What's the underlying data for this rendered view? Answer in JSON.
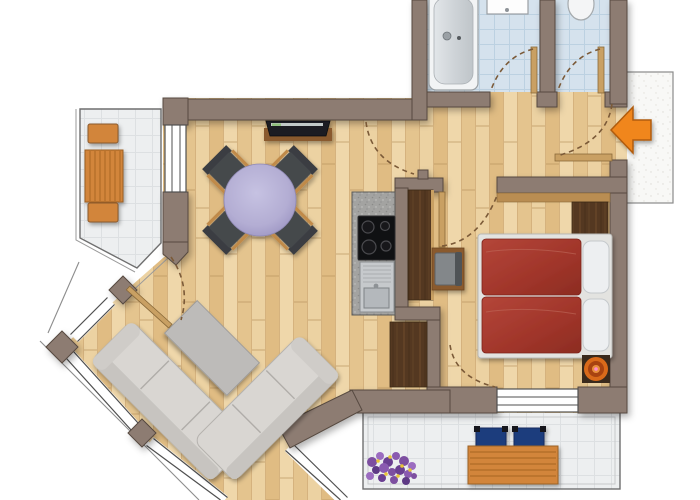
{
  "title": "apartment-floor-plan",
  "colors": {
    "wall": "#8d7b72",
    "wall_edge": "#574a40",
    "floor_wood": "#eacf9e",
    "tile_bathroom": "#d5e2ed",
    "tile_bathroom_line": "#bcd1e1",
    "tile_balcony": "#edeff0",
    "tile_balcony_line": "#dde0e2",
    "railing": "#6f6f6f",
    "sofa": "#d9d6d2",
    "coffee_table": "#bdbbb9",
    "dining_table": "#b5afd4",
    "dining_chair": "#45484c",
    "chair_wood_trim": "#c08a4a",
    "counter_granite": "#a3a3a1",
    "cooktop": "#101113",
    "sink_steel": "#c6c9cc",
    "wardrobe_wood": "#543821",
    "shelf_wood": "#b98d52",
    "door_wood": "#c9a063",
    "door_arc": "#7b5a38",
    "bed_duvet": "#a63a2f",
    "bed_frame": "#e3e3e0",
    "pillow": "#edeff1",
    "stool_orange": "#d96a1a",
    "entrance_arrow": "#f0861c",
    "outdoor_wood": "#d2853b",
    "outdoor_chair_blue": "#1f3d7d",
    "flower_purple": "#7d4fa0",
    "flower_yellow": "#e8c437",
    "bathtub": "#f2f4f5",
    "landing": "#f8f8f6"
  },
  "rooms": [
    {
      "id": "living-dining",
      "label": "living-dining-area"
    },
    {
      "id": "kitchen-nook",
      "label": "kitchen-nook"
    },
    {
      "id": "hallway",
      "label": "hallway"
    },
    {
      "id": "bathroom",
      "label": "bathroom-with-tub"
    },
    {
      "id": "wc",
      "label": "separate-wc"
    },
    {
      "id": "bedroom",
      "label": "bedroom"
    },
    {
      "id": "balcony-west",
      "label": "west-balcony"
    },
    {
      "id": "balcony-south",
      "label": "south-balcony"
    },
    {
      "id": "entry-landing",
      "label": "stair-landing"
    }
  ],
  "furniture": [
    "bathtub",
    "wash-basin",
    "toilet",
    "tv-on-board",
    "round-dining-table",
    "four-dining-chairs",
    "kitchen-counter-with-cooktop-and-sink",
    "tall-wardrobe-niche",
    "hall-wardrobe",
    "bedroom-dresser",
    "desk-with-chair",
    "double-bed-red-duvets",
    "orange-stool",
    "corner-sofa",
    "coffee-table",
    "balcony-lounger-set",
    "patio-table-two-blue-chairs",
    "flower-pot"
  ],
  "doors": [
    "entrance-door",
    "bathroom-door",
    "wc-door",
    "living-room-door",
    "bedroom-door",
    "patio-door-bay",
    "bedroom-balcony-door"
  ],
  "annotations": {
    "entrance_marker": "orange-arrow-pointing-left"
  }
}
